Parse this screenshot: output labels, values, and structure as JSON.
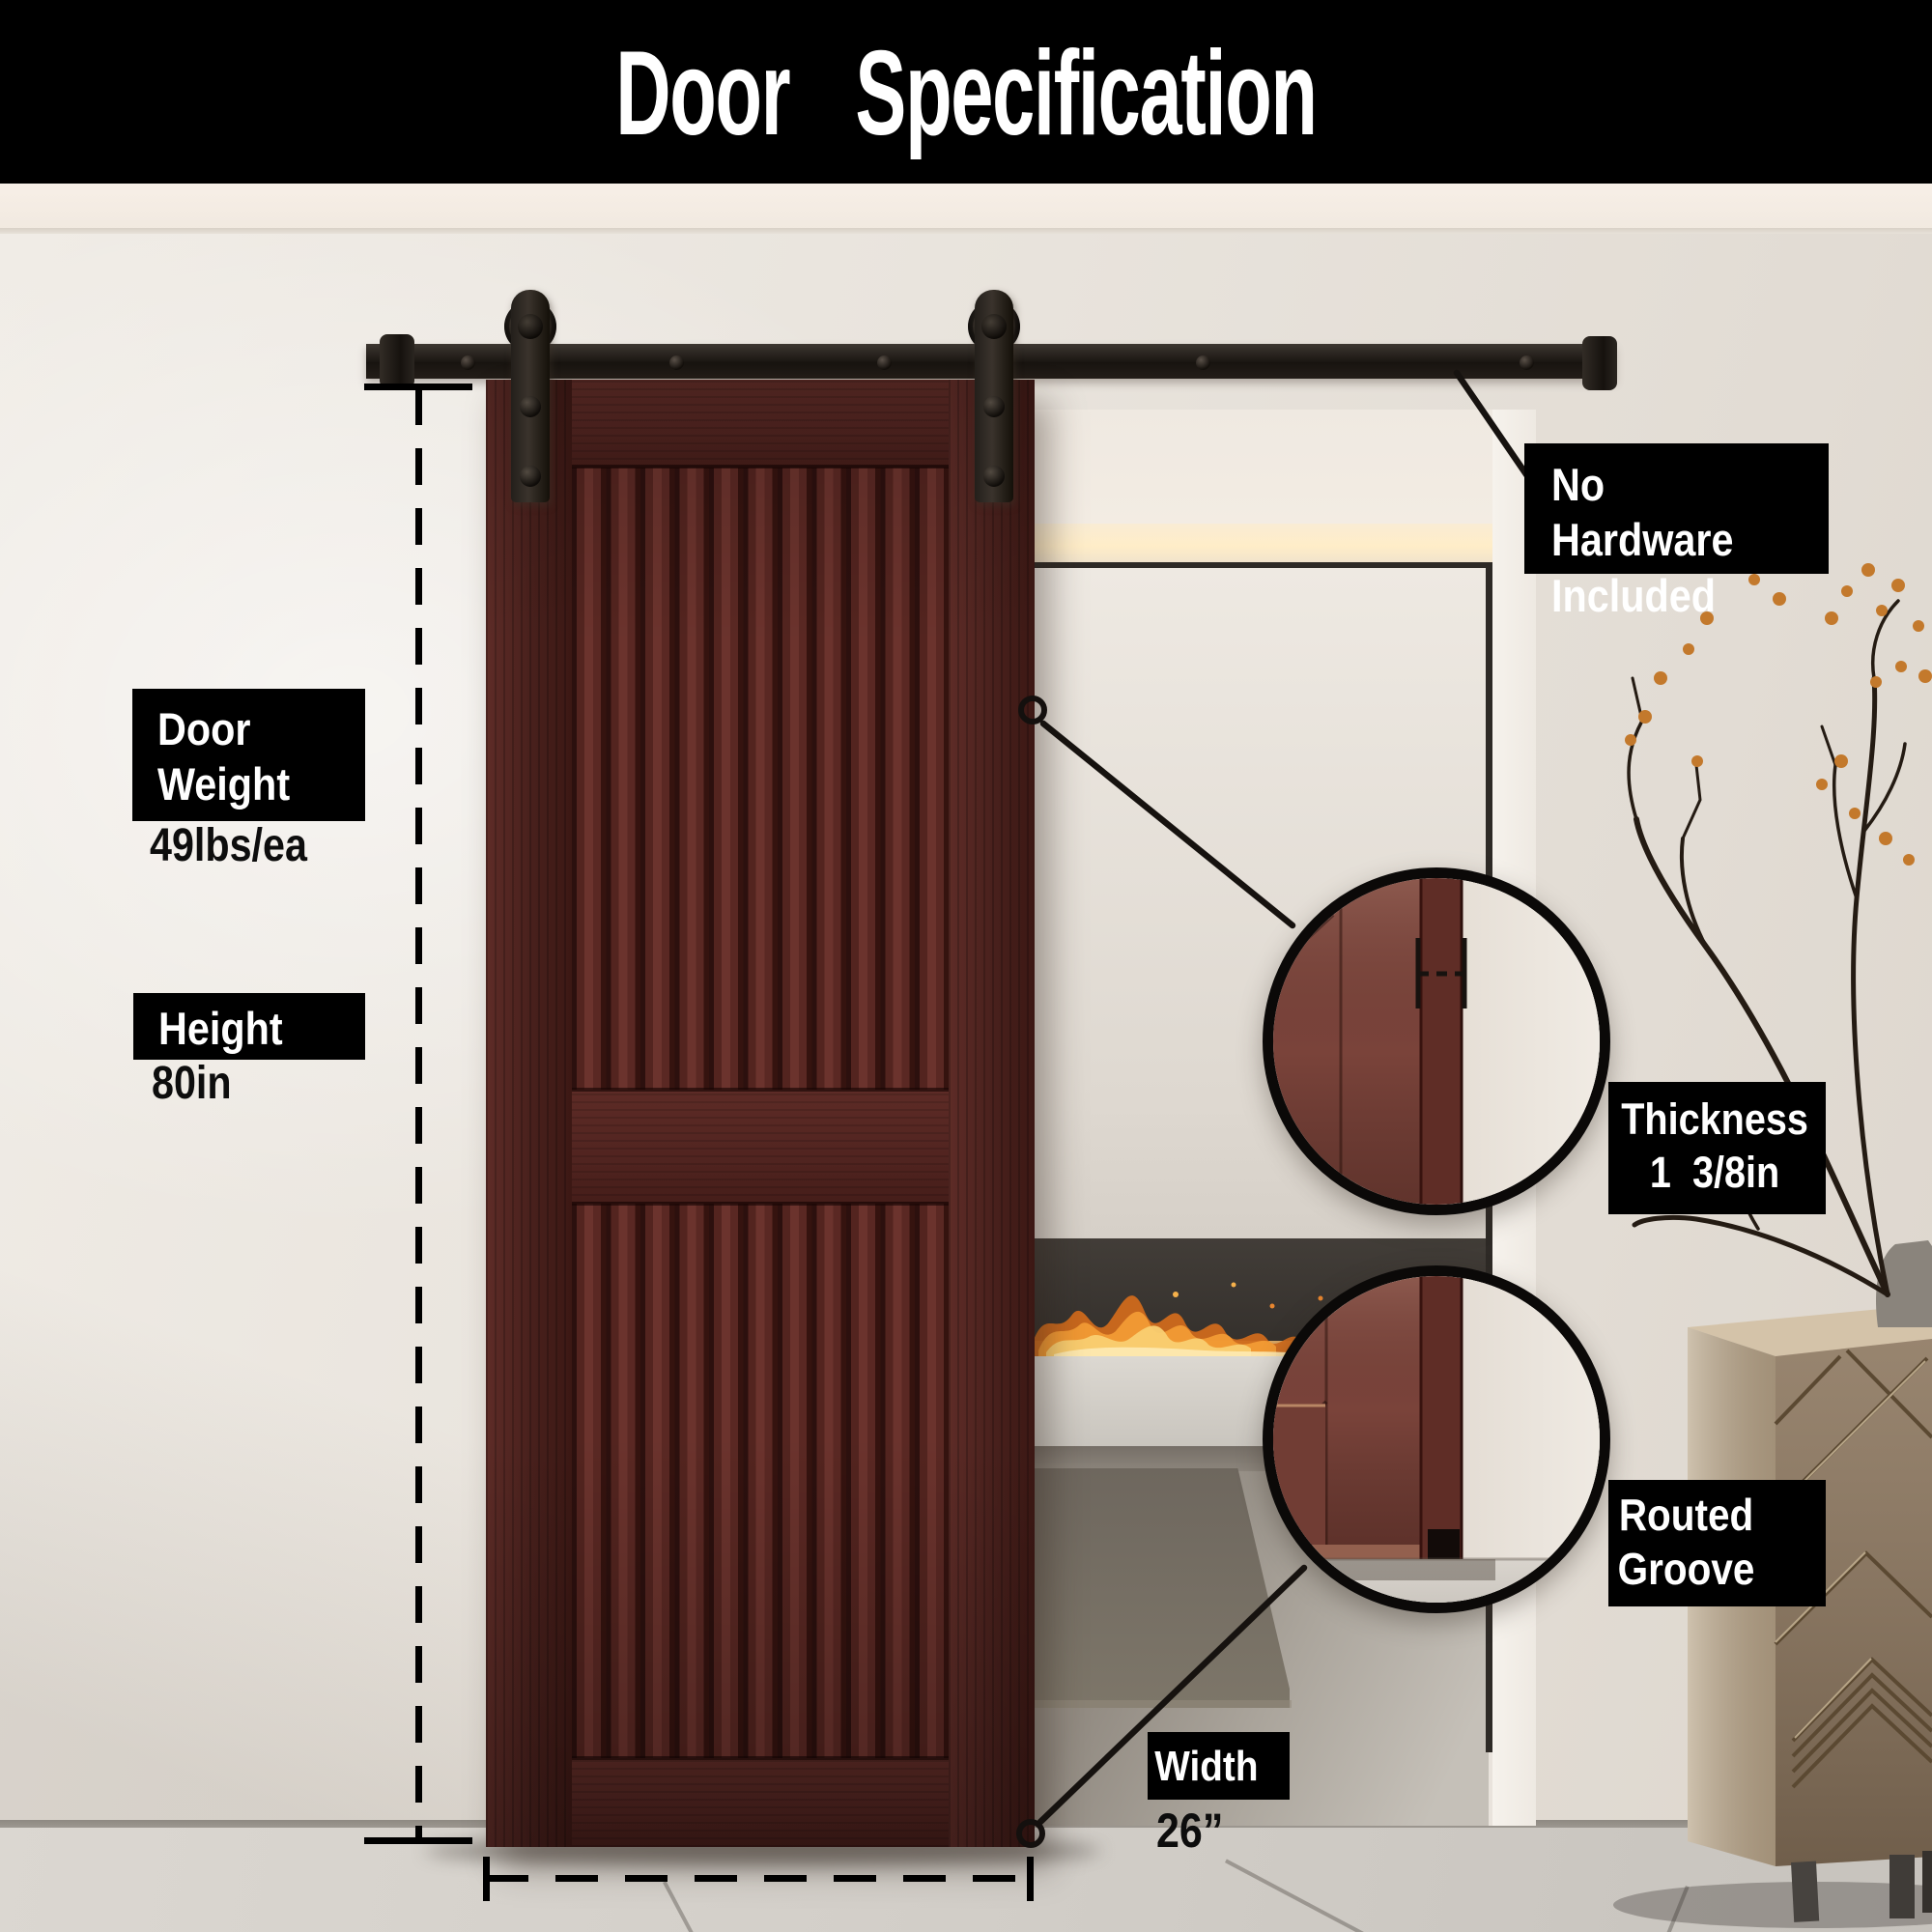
{
  "header": {
    "title": "Door Specification"
  },
  "annotations": {
    "no_hardware": {
      "text": "No Hardware\nIncluded"
    },
    "door_weight": {
      "label": "Door\nWeight",
      "value": "49lbs/ea"
    },
    "height": {
      "label": "Height",
      "value": "80in"
    },
    "thickness": {
      "label": "Thickness\n1  3/8in"
    },
    "routed_groove": {
      "label": "Routed\nGroove"
    },
    "width": {
      "label": "Width",
      "value": "26”"
    }
  },
  "specs": {
    "door_weight_lbs_each": 49,
    "height_in": 80,
    "width_in": 26,
    "thickness_in": "1 3/8",
    "hardware_included": false,
    "features": [
      "Routed Groove"
    ]
  },
  "icons": {
    "callout_marker": "circle-outline",
    "zoom_lens": "magnifier-circle",
    "door_roller": "barn-door-roller-wheel"
  },
  "colors": {
    "banner_bg": "#000000",
    "banner_fg": "#ffffff",
    "door_wood": "#53261f",
    "hardware_black": "#17120f",
    "wall": "#e9e4dd",
    "floor": "#d3cfc9",
    "flame_orange": "#ef9b33",
    "berry_orange": "#c3792c"
  }
}
